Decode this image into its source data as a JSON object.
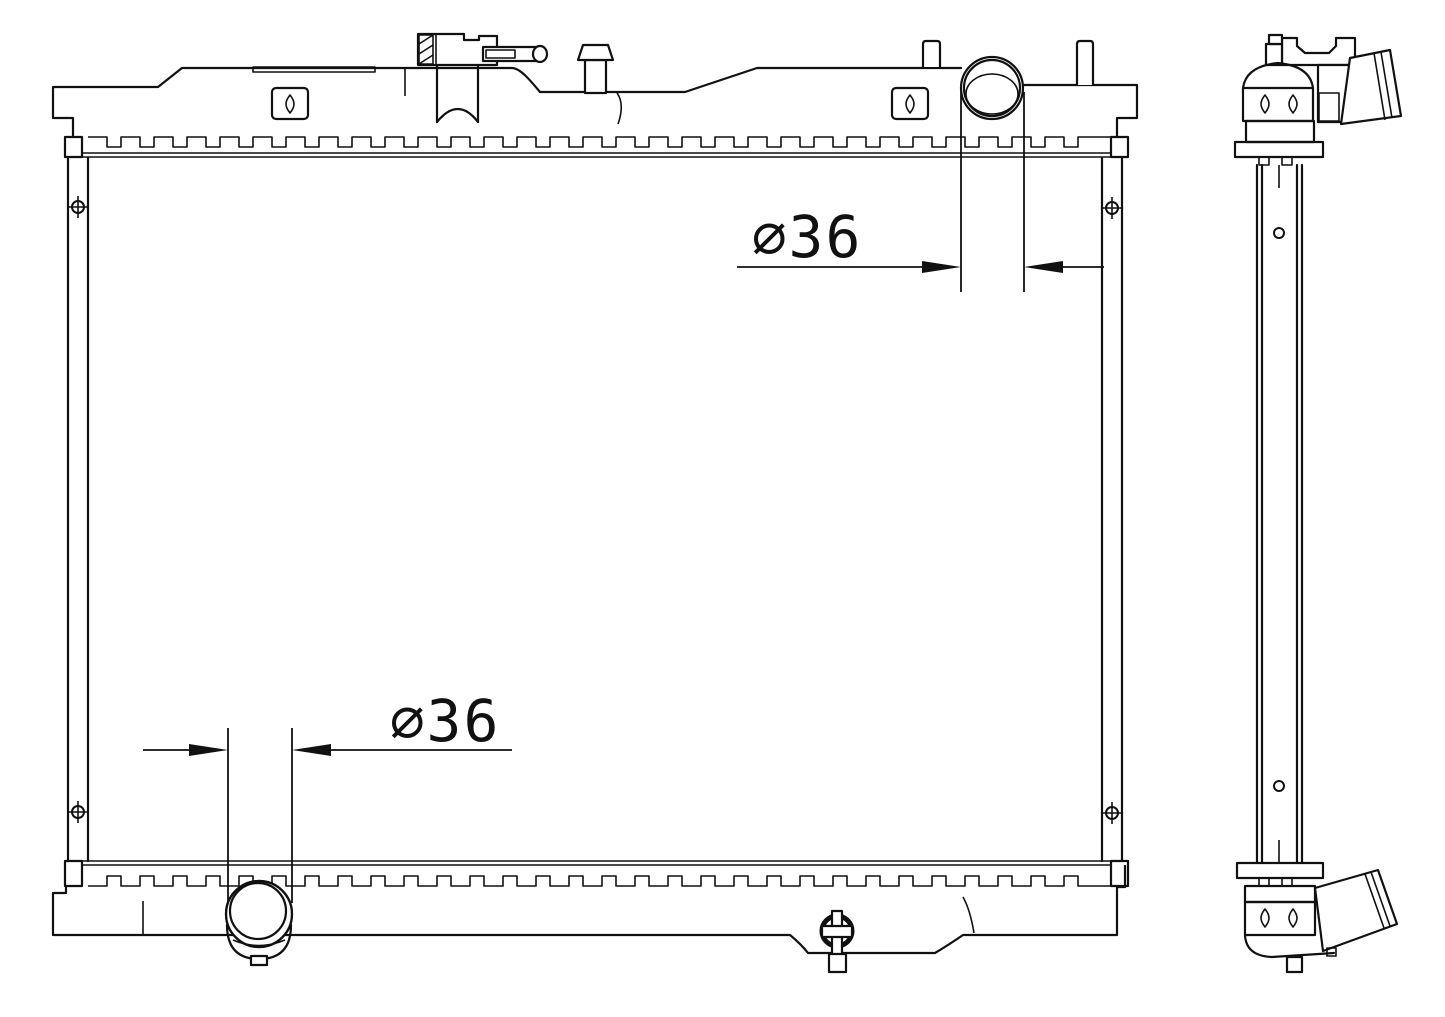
{
  "drawing": {
    "kind": "radiator-engineering-line-drawing",
    "background": "#ffffff",
    "line_color": "#111111"
  },
  "dimensions": {
    "top_inlet_diameter": {
      "label": "⌀36"
    },
    "bottom_outlet_diameter": {
      "label": "⌀36"
    }
  }
}
